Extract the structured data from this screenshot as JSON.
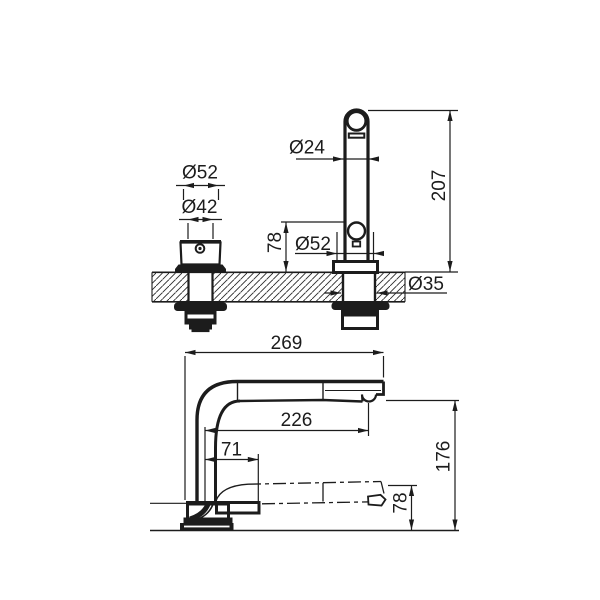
{
  "drawing_type": "faucet technical dimension drawing",
  "colors": {
    "line": "#1c1c1c",
    "background": "#ffffff"
  },
  "views": {
    "front": {
      "label": "front-view-with-countertop-section",
      "dims": {
        "handle_cap_diameter": "Ø52",
        "handle_body_diameter": "Ø42",
        "spout_tube_diameter": "Ø24",
        "spout_height": "207",
        "joint_height": "78",
        "spout_base_diameter": "Ø52",
        "shank_diameter": "Ø35"
      }
    },
    "side": {
      "label": "side-profile-view",
      "dims": {
        "overall_depth": "269",
        "outlet_reach": "226",
        "dock_offset": "71",
        "overall_height": "176",
        "lowered_outlet_height": "78"
      }
    }
  }
}
